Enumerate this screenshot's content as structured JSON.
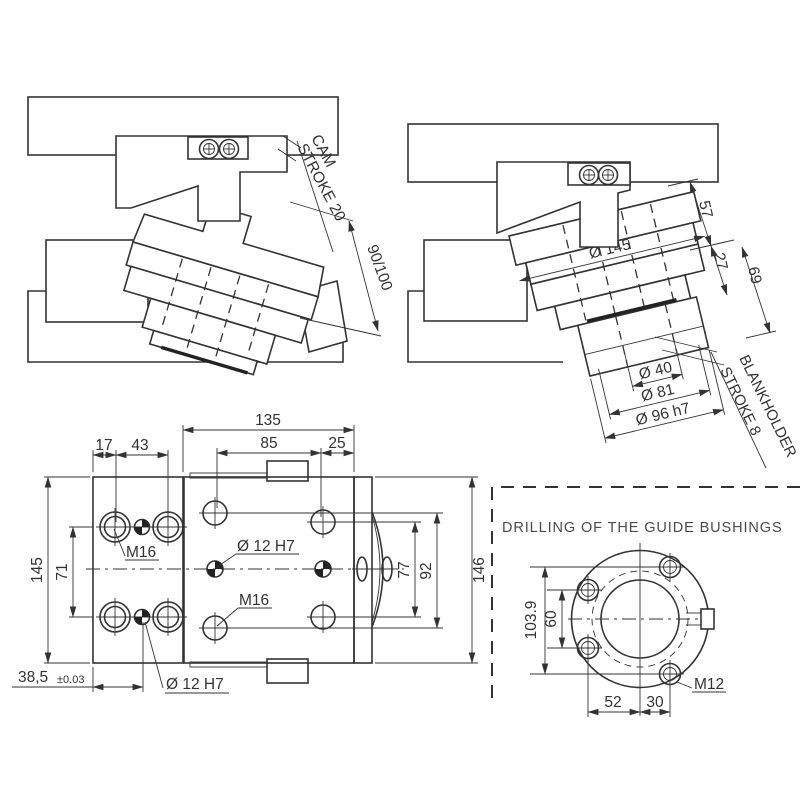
{
  "meta": {
    "background": "#ffffff",
    "line_color": "#333333",
    "title_color": "#4a4a4a"
  },
  "cam_view": {
    "cam_label_line1": "CAM",
    "cam_label_line2": "STROKE 20",
    "travel_dim": "90/100"
  },
  "blank_view": {
    "dia145": "Ø 145",
    "d57": "57",
    "d27": "27",
    "d69": "69",
    "dia40": "Ø 40",
    "dia81": "Ø 81",
    "dia96": "Ø 96 h7",
    "blankholder_line1": "BLANKHOLDER",
    "blankholder_line2": "STROKE 8"
  },
  "plan_view": {
    "w135": "135",
    "w85": "85",
    "w25": "25",
    "w17": "17",
    "w43": "43",
    "h145": "145",
    "h71": "71",
    "h77": "77",
    "h92": "92",
    "h146": "146",
    "base_dim": "38,5",
    "base_tol": "±0.03",
    "m16_left": "M16",
    "m16_body": "M16",
    "dowel_center": "Ø 12 H7",
    "dowel_bottom": "Ø 12 H7"
  },
  "bushing_view": {
    "title": "DRILLING OF THE GUIDE BUSHINGS",
    "v1039": "103.9",
    "v60": "60",
    "v52": "52",
    "v30": "30",
    "m12": "M12"
  }
}
